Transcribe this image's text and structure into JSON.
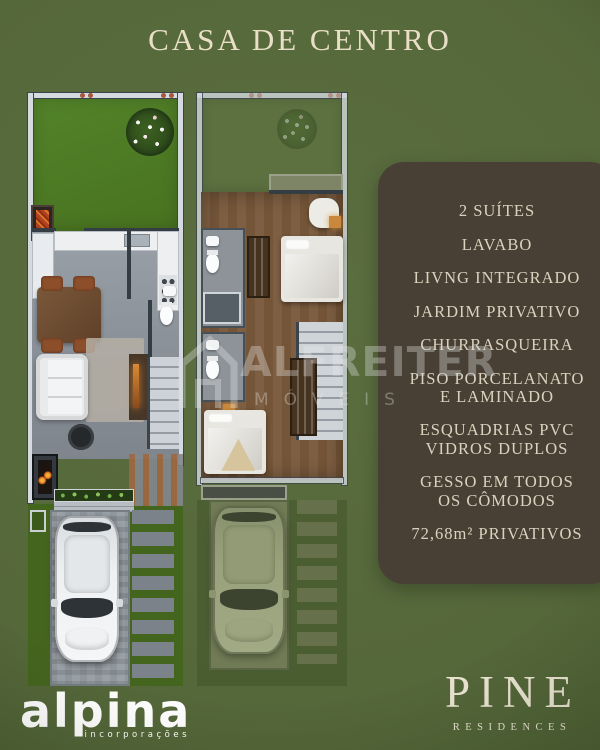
{
  "title": "CASA DE CENTRO",
  "features": {
    "items": [
      "2 SUÍTES",
      "LAVABO",
      "LIVNG INTEGRADO",
      "JARDIM PRIVATIVO",
      "CHURRASQUEIRA",
      "PISO PORCELANATO\nE LAMINADO",
      "ESQUADRIAS PVC\nVIDROS DUPLOS",
      "GESSO EM TODOS\nOS CÔMODOS",
      "72,68m² PRIVATIVOS"
    ]
  },
  "watermark": {
    "name": "ALFREITER",
    "subtitle": "MÓVEIS"
  },
  "brands": {
    "alpina": {
      "name": "alpina",
      "tagline": "incorporações"
    },
    "pine": {
      "name": "PINE",
      "subtitle": "RESIDENCES"
    }
  },
  "colors": {
    "background_green": "#55683a",
    "panel_brown": "#484034",
    "title_cream": "#e9dfc6",
    "feature_text": "#dad2bf",
    "garden_green": "#4e7b26",
    "logo_white": "#ffffff",
    "pine_cream": "#ebe4d2"
  }
}
